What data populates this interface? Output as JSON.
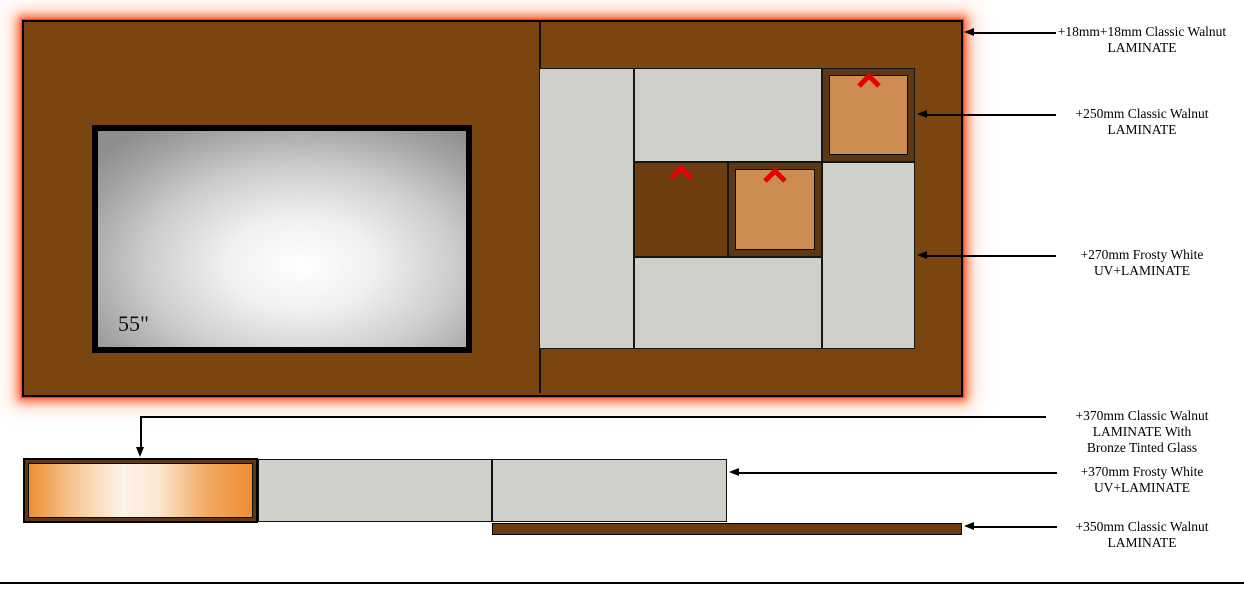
{
  "diagram": {
    "tv_size_label": "55\"",
    "annotations": [
      {
        "lines": [
          "+18mm+18mm Classic Walnut",
          "LAMINATE"
        ]
      },
      {
        "lines": [
          "+250mm Classic Walnut",
          "LAMINATE"
        ]
      },
      {
        "lines": [
          "+270mm Frosty White",
          "UV+LAMINATE"
        ]
      },
      {
        "lines": [
          "+370mm Classic Walnut",
          "LAMINATE With",
          "Bronze Tinted Glass"
        ]
      },
      {
        "lines": [
          "+370mm Frosty White",
          "UV+LAMINATE"
        ]
      },
      {
        "lines": [
          "+350mm Classic Walnut",
          "LAMINATE"
        ]
      }
    ],
    "colors": {
      "walnut": "#7a450f",
      "walnut_dark": "#6e3e10",
      "frame_dark": "#5c3813",
      "plinth": "#6b3c11",
      "frosty_white": "#d0d0cb",
      "orange_panel": "#cd8c52",
      "glow": "#ff4a1a",
      "chevron_red": "#e60000"
    }
  }
}
